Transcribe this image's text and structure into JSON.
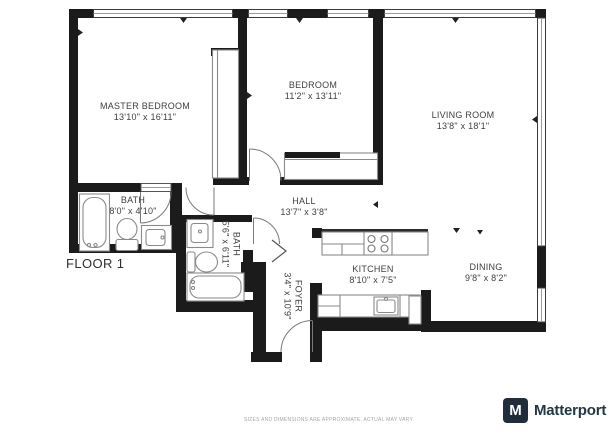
{
  "floorplan": {
    "floor_label": "FLOOR 1",
    "rooms": [
      {
        "id": "master-bedroom",
        "name": "MASTER BEDROOM",
        "dims": "13'10\" x 16'11\""
      },
      {
        "id": "bedroom",
        "name": "BEDROOM",
        "dims": "11'2\" x 13'11\""
      },
      {
        "id": "living-room",
        "name": "LIVING ROOM",
        "dims": "13'8\" x 18'1\""
      },
      {
        "id": "bath",
        "name": "BATH",
        "dims": "8'0\" x 4'10\""
      },
      {
        "id": "bath-2",
        "name": "BATH",
        "dims": "5'6\" x 6'11\""
      },
      {
        "id": "hall",
        "name": "HALL",
        "dims": "13'7\" x 3'8\""
      },
      {
        "id": "foyer",
        "name": "FOYER",
        "dims": "3'4\" x 10'9\""
      },
      {
        "id": "kitchen",
        "name": "KITCHEN",
        "dims": "8'10\" x 7'5\""
      },
      {
        "id": "dining",
        "name": "DINING",
        "dims": "9'8\" x 8'2\""
      }
    ],
    "fixtures": [
      "bathtub",
      "toilet",
      "sink-vanity",
      "bathtub-2",
      "toilet-2",
      "sink-vanity-2",
      "stove",
      "kitchen-sink",
      "closet",
      "closet-2",
      "fridge"
    ],
    "colors": {
      "wall": "#1b1b1b",
      "fixture_outline": "#8a8a8a",
      "label_text": "#3f3f3f"
    }
  },
  "footer": {
    "disclaimer": "SIZES AND DIMENSIONS ARE APPROXIMATE, ACTUAL MAY VARY.",
    "brand": "Matterport",
    "brand_initial": "M",
    "brand_color": "#243746"
  }
}
